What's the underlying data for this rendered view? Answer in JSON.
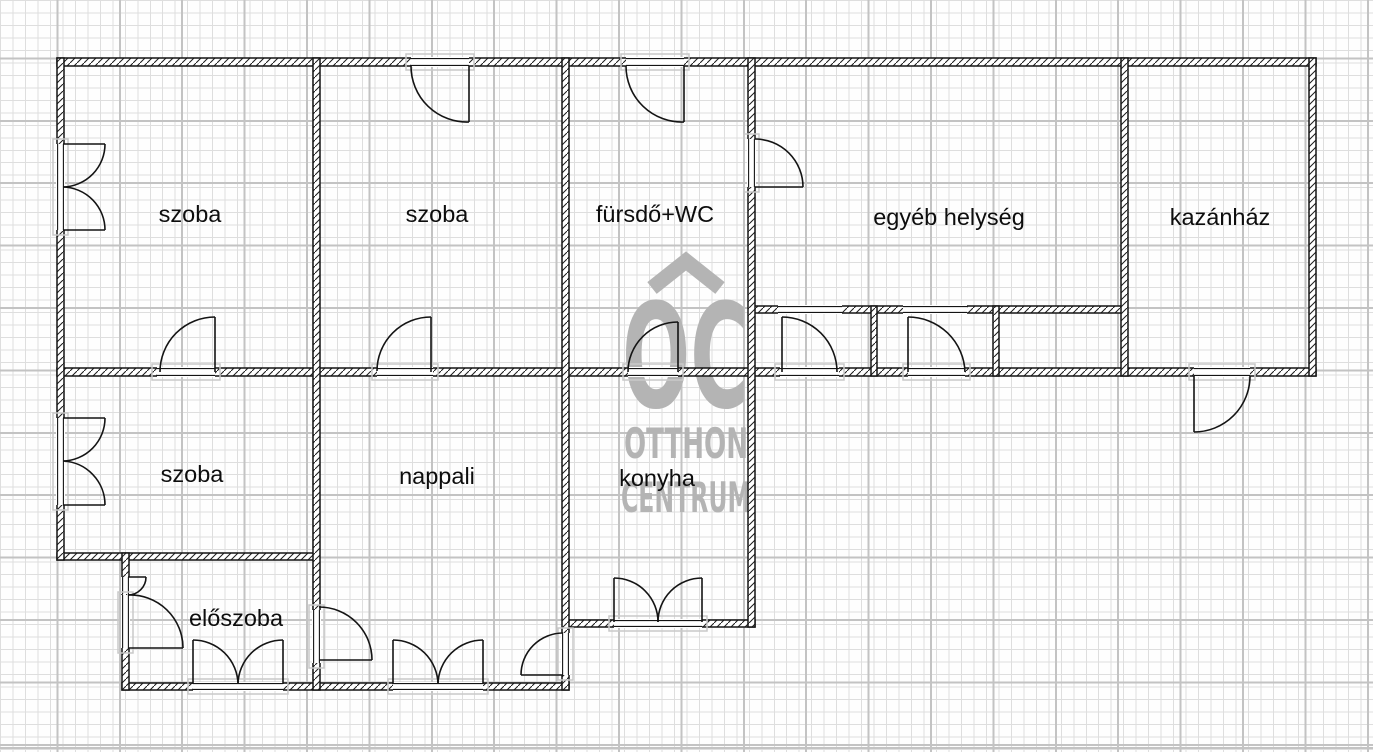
{
  "plan": {
    "title": "floor-plan",
    "rooms": [
      {
        "id": "szoba-top-left",
        "label": "szoba"
      },
      {
        "id": "szoba-top-middle",
        "label": "szoba"
      },
      {
        "id": "furdo-wc",
        "label": "fürsdő+WC"
      },
      {
        "id": "egyeb-helyseg",
        "label": "egyéb helység"
      },
      {
        "id": "kazanhaz",
        "label": "kazánház"
      },
      {
        "id": "szoba-bottom-left",
        "label": "szoba"
      },
      {
        "id": "nappali",
        "label": "nappali"
      },
      {
        "id": "konyha",
        "label": "konyha"
      },
      {
        "id": "eloszoba",
        "label": "előszoba"
      }
    ],
    "watermark": {
      "logo_text": "OC",
      "line1": "OTTHON",
      "line2": "CENTRUM",
      "color": "#b4b4b4"
    },
    "colors": {
      "wall_line": "#141414",
      "grid_minor": "#dedede",
      "grid_major": "#c3c3c3",
      "paper": "#fefefe",
      "threshold": "#c9c9c9"
    }
  }
}
